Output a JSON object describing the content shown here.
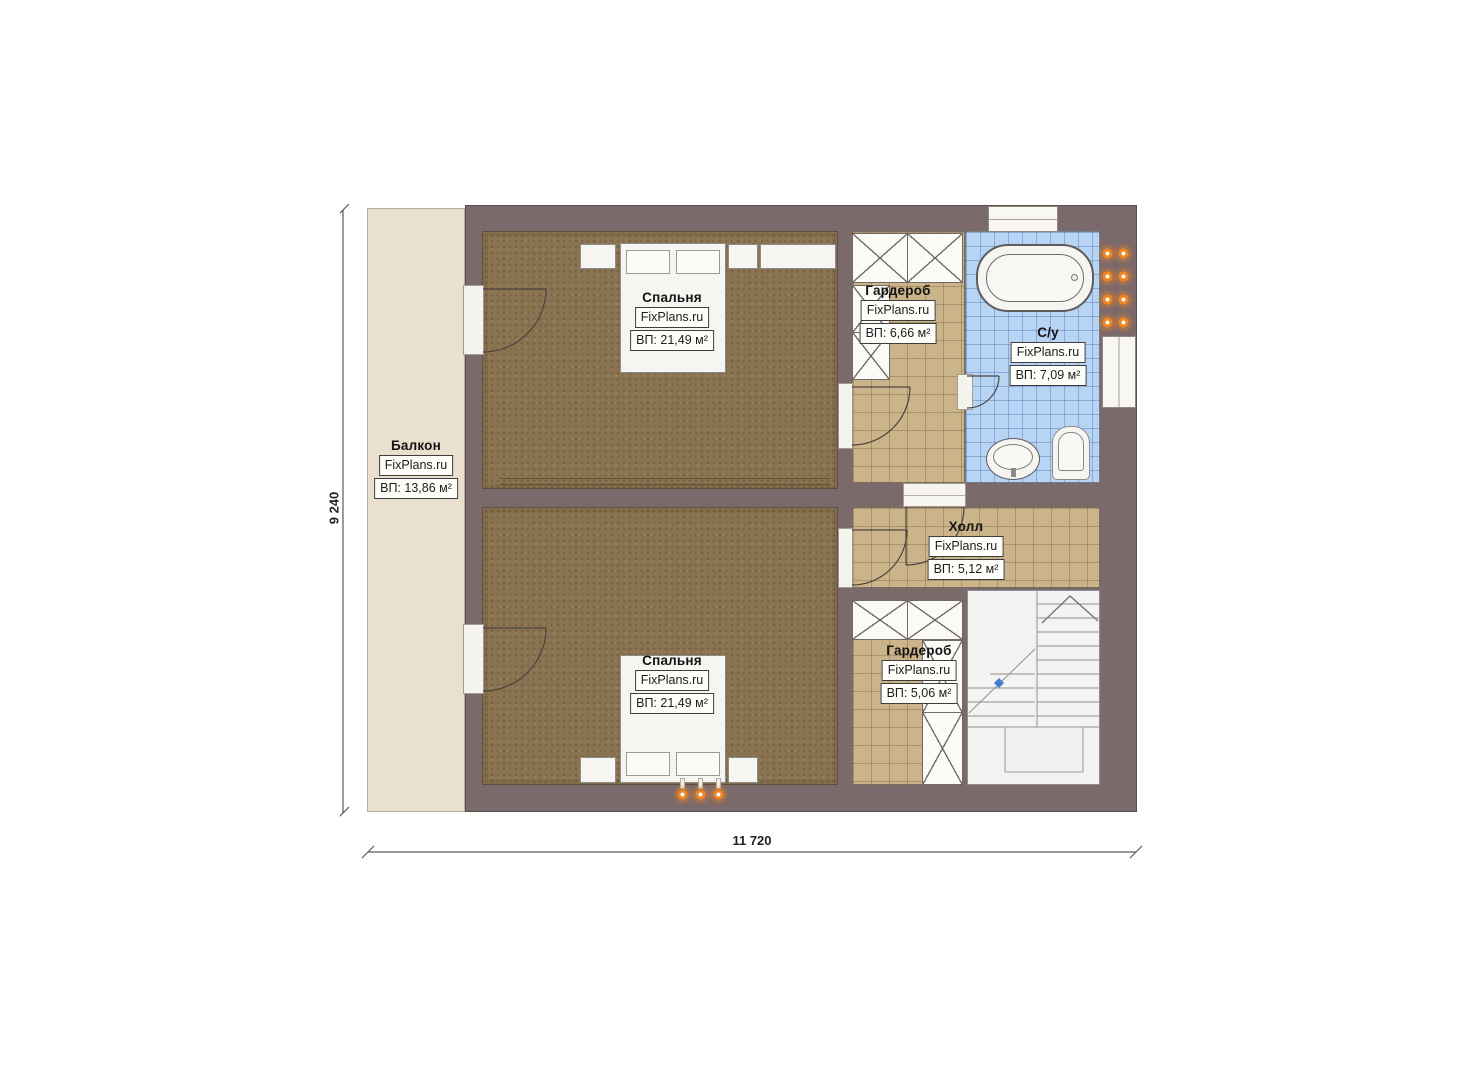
{
  "plan": {
    "watermark": "FixPlans.ru",
    "rooms": [
      {
        "id": "balcony",
        "name": "Балкон",
        "area": "ВП: 13,86 м²"
      },
      {
        "id": "bedroom-top",
        "name": "Спальня",
        "area": "ВП: 21,49 м²"
      },
      {
        "id": "wardrobe-top",
        "name": "Гардероб",
        "area": "ВП: 6,66 м²"
      },
      {
        "id": "bathroom",
        "name": "С/у",
        "area": "ВП: 7,09 м²"
      },
      {
        "id": "hall",
        "name": "Холл",
        "area": "ВП: 5,12 м²"
      },
      {
        "id": "bedroom-bottom",
        "name": "Спальня",
        "area": "ВП: 21,49 м²"
      },
      {
        "id": "wardrobe-bottom",
        "name": "Гардероб",
        "area": "ВП: 5,06 м²"
      }
    ],
    "dimensions": {
      "width": "11 720",
      "height": "9 240"
    },
    "colors": {
      "wall": "#7b6a6b",
      "balcony_floor": "#e9e0cd",
      "bedroom_floor": "#8a7350",
      "tile_tan": "#cbb489",
      "tile_blue": "#b7d4f4",
      "radiator": "#f08322",
      "stair_marker": "#3f7fd0"
    }
  }
}
